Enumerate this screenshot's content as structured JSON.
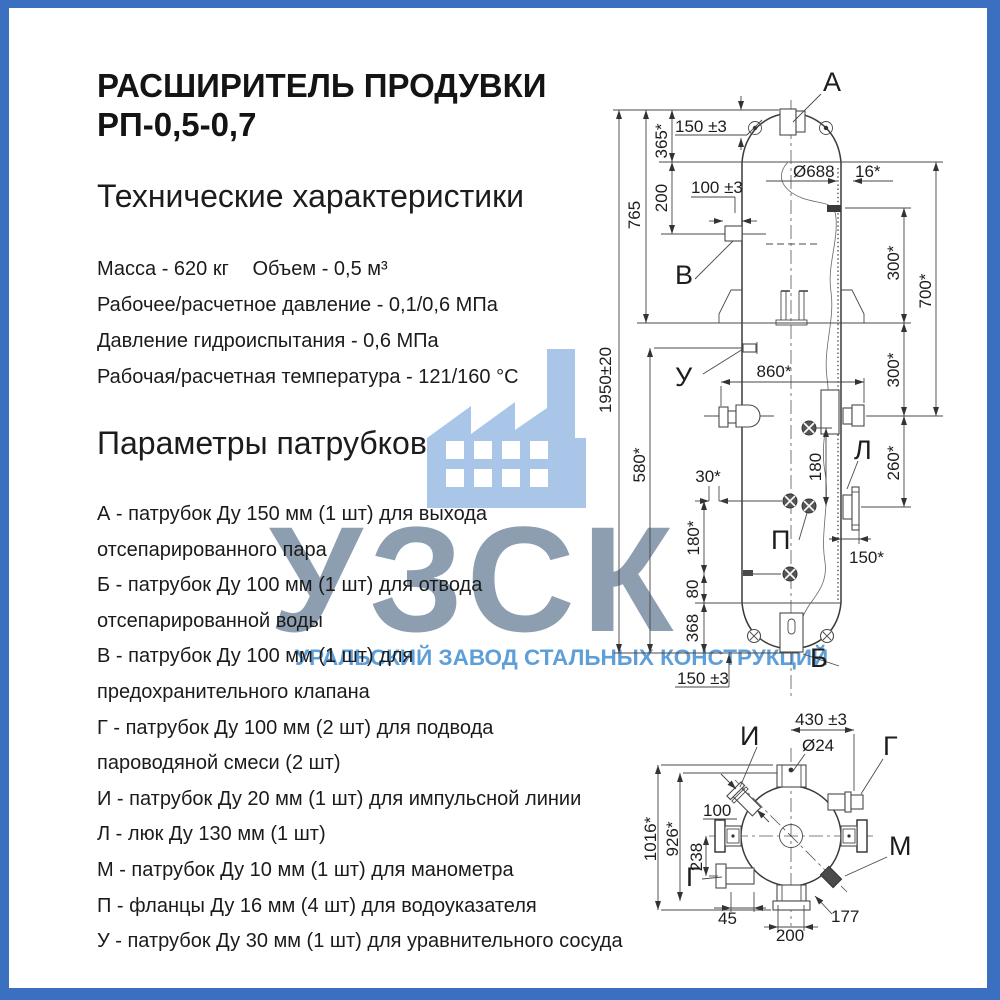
{
  "frame": {
    "border_color": "#3b70c1"
  },
  "title": {
    "line1": "РАСШИРИТЕЛЬ ПРОДУВКИ",
    "line2": "РП-0,5-0,7"
  },
  "specs": {
    "heading": "Технические характеристики",
    "mass": "Масса - 620 кг",
    "volume": "Объем - 0,5 м³",
    "lines": [
      "Рабочее/расчетное давление - 0,1/0,6 МПа",
      "Давление гидроиспытания - 0,6 МПа",
      "Рабочая/расчетная температура - 121/160 °С"
    ]
  },
  "nozzle_params": {
    "heading": "Параметры патрубков",
    "items": [
      "А - патрубок Ду 150 мм (1 шт) для выхода отсепарированного пара",
      "Б - патрубок Ду 100 мм (1 шт) для отвода отсепарированной воды",
      "В - патрубок Ду 100 мм (1 шт) для предохранительного клапана",
      "Г - патрубок Ду 100 мм (2 шт) для подвода пароводяной смеси (2 шт)",
      "И - патрубок Ду 20 мм (1 шт) для импульсной линии",
      "Л - люк Ду 130 мм (1 шт)",
      "М - патрубок Ду 10 мм (1 шт) для манометра",
      "П - фланцы Ду 16 мм (4 шт) для водоуказателя",
      "У - патрубок Ду 30 мм (1 шт) для уравнительного сосуда"
    ]
  },
  "watermark": {
    "acronym": "УЗСК",
    "company": "УРАЛЬСКИЙ ЗАВОД СТАЛЬНЫХ КОНСТРУКЦИЙ",
    "acronym_color": "#8496ab",
    "company_color": "#5f9fd8",
    "factory_icon_color": "#a9c6e9"
  },
  "front_view": {
    "labels": {
      "a": "А",
      "b": "Б",
      "v": "В",
      "u": "У",
      "l": "Л",
      "p": "П"
    },
    "dims": {
      "overall_height": "1950±20",
      "h765": "765",
      "h580": "580*",
      "h365": "365*",
      "h200": "200",
      "nozzle_a_height": "150 ±3",
      "nozzle_v_width": "100 ±3",
      "shell_dia": "Ø688",
      "wall": "16*",
      "width_860": "860*",
      "offset_30": "30*",
      "gauge_180": "180",
      "right_300_upper": "300*",
      "right_700": "700*",
      "right_300_lower": "300*",
      "right_260": "260*",
      "manhole_150": "150*",
      "left_180": "180*",
      "left_80": "80",
      "left_368": "368",
      "nozzle_b_150": "150 ±3"
    }
  },
  "plan_view": {
    "labels": {
      "i": "И",
      "g_top": "Г",
      "m": "М",
      "g_bottom": "Г"
    },
    "dims": {
      "d430": "430 ±3",
      "dia24": "Ø24",
      "d100": "100",
      "d1016": "1016*",
      "d926": "926*",
      "d238": "238",
      "d45": "45",
      "d200": "200",
      "d177": "177"
    }
  }
}
